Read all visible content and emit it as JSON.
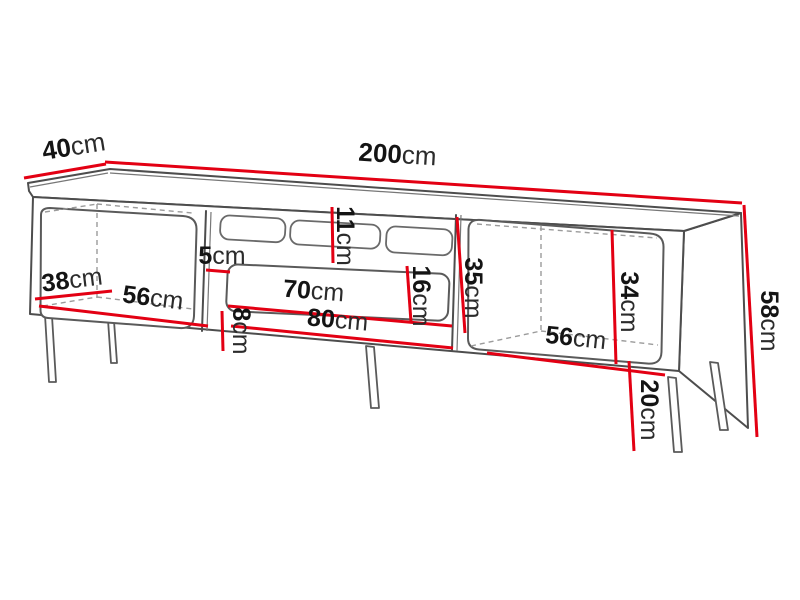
{
  "diagram": {
    "kind": "furniture-dimension-diagram",
    "subject": "TV stand with two side cabinets, middle open shelf and metal legs",
    "unit": "cm",
    "colors": {
      "dimension_line": "#e30013",
      "outline": "#4d4d4d",
      "dashed_line": "#9b9b9b",
      "text": "#141414",
      "background": "#ffffff"
    },
    "dims": {
      "d40": {
        "value": "40",
        "unit": "cm"
      },
      "d200": {
        "value": "200",
        "unit": "cm"
      },
      "d38": {
        "value": "38",
        "unit": "cm"
      },
      "d56_left": {
        "value": "56",
        "unit": "cm"
      },
      "d5": {
        "value": "5",
        "unit": "cm"
      },
      "d11": {
        "value": "11",
        "unit": "cm"
      },
      "d16": {
        "value": "16",
        "unit": "cm"
      },
      "d70": {
        "value": "70",
        "unit": "cm"
      },
      "d80": {
        "value": "80",
        "unit": "cm"
      },
      "d8": {
        "value": "8",
        "unit": "cm"
      },
      "d35": {
        "value": "35",
        "unit": "cm"
      },
      "d34": {
        "value": "34",
        "unit": "cm"
      },
      "d56_right": {
        "value": "56",
        "unit": "cm"
      },
      "d20": {
        "value": "20",
        "unit": "cm"
      },
      "d58": {
        "value": "58",
        "unit": "cm"
      }
    }
  }
}
